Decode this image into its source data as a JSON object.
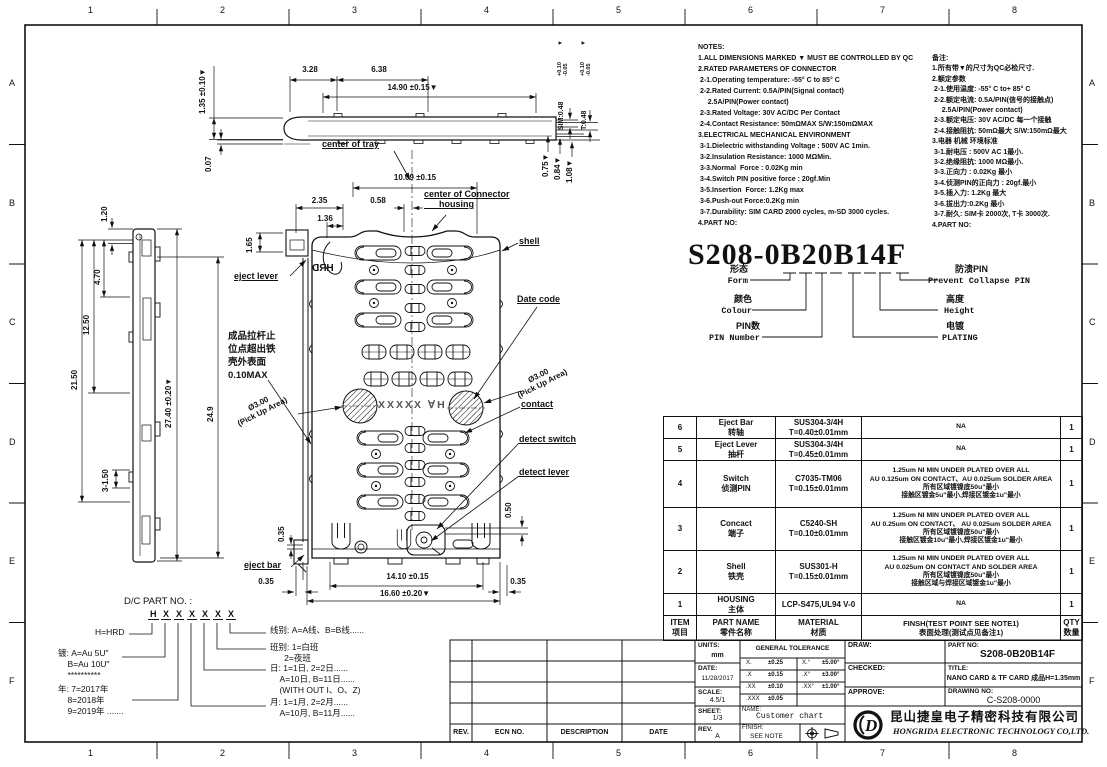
{
  "sheet": {
    "zone_cols": [
      "1",
      "2",
      "3",
      "4",
      "5",
      "6",
      "7",
      "8"
    ],
    "zone_rows": [
      "A",
      "B",
      "C",
      "D",
      "E",
      "F"
    ]
  },
  "notes_en": "NOTES:\n1.ALL DIMENSIONS MARKED ▼ MUST BE CONTROLLED BY QC\n2.RATED PARAMETERS OF CONNECTOR\n 2-1.Operating temperature: -55° C to 85° C\n 2-2.Rated Current: 0.5A/PIN(Signal contact)\n     2.5A/PIN(Power contact)\n 2-3.Rated Voltage: 30V AC/DC Per Contact\n 2-4.Contact Resistance: 50mΩMAX S/W:150mΩMAX\n3.ELECTRICAL MECHANICAL ENVIRONMENT\n 3-1.Dielectric withstanding Voltage : 500V AC 1min.\n 3-2.Insulation Resistance: 1000 MΩMin.\n 3-3.Normal  Force : 0.02Kg min\n 3-4.Switch PIN positive force : 20gf.Min\n 3-5.Insertion  Force: 1.2Kg max\n 3-6.Push-out Force:0.2Kg min\n 3-7.Durability: SIM CARD 2000 cycles, m-SD 3000 cycles.\n4.PART NO:",
  "notes_cn": "备注:\n1.所有带▼的尺寸为QC必检尺寸.\n2.额定参数\n 2-1.使用温度: -55° C to+ 85° C\n 2-2.额定电流: 0.5A/PIN(信号的接触点)\n     2.5A/PIN(Power contact)\n 2-3.额定电压: 30V AC/DC 每一个接触\n 2-4.接触阻抗: 50mΩ最大 S/W:150mΩ最大\n3.电器 机械 环境标准\n 3-1.耐电压 : 500V AC 1最小.\n 3-2.绝缘阻抗: 1000 MΩ最小.\n 3-3.正向力 : 0.02Kg 最小\n 3-4.侦测PIN的正向力 : 20gf.最小\n 3-5.插入力: 1.2Kg 最大\n 3-6.拔出力:0.2Kg 最小\n 3-7.耐久: SIM卡 2000次, T卡 3000次.\n4.PART NO:",
  "part_code": {
    "number": "S208-0B20B14F",
    "form_cn": "形态",
    "form_en": "Form",
    "colour_cn": "颜色",
    "colour_en": "Colour",
    "pin_cn": "PIN数",
    "pin_en": "PIN Number",
    "prevent_cn": "防溃PIN",
    "prevent_en": "Prevent Collapse PIN",
    "height_cn": "高度",
    "height_en": "Height",
    "plating_cn": "电镀",
    "plating_en": "PLATING"
  },
  "bom": {
    "header": {
      "item": "ITEM\n项目",
      "part_name": "PART NAME\n零件名称",
      "material": "MATERIAL\n材质",
      "finish": "FINSH(TEST POINT SEE NOTE1)\n表面处理(测试点见备注1)",
      "qty": "QTY\n数量"
    },
    "rows": [
      {
        "item": "6",
        "part_name": "Eject Bar\n转轴",
        "material": "SUS304-3/4H\nT=0.40±0.01mm",
        "finish": "NA",
        "qty": "1"
      },
      {
        "item": "5",
        "part_name": "Eject Lever\n抽杆",
        "material": "SUS304-3/4H\nT=0.45±0.01mm",
        "finish": "NA",
        "qty": "1"
      },
      {
        "item": "4",
        "part_name": "Switch\n侦测PIN",
        "material": "C7035-TM06\nT=0.15±0.01mm",
        "finish": "1.25um NI MIN UNDER PLATED OVER ALL\nAU 0.125um ON CONTACT、AU 0.025um SOLDER AREA\n所有区域镀镍底50u\"最小\n接触区镀金5u\"最小,焊接区镀金1u\"最小",
        "qty": "1"
      },
      {
        "item": "3",
        "part_name": "Concact\n端子",
        "material": "C5240-SH\nT=0.10±0.01mm",
        "finish": "1.25um NI MIN UNDER PLATED OVER ALL\nAU 0.25um ON CONTACT、 AU 0.025um SOLDER AREA\n所有区域镀镍底50u\"最小\n接触区镀金10u\"最小,焊接区镀金1u\"最小",
        "qty": "1"
      },
      {
        "item": "2",
        "part_name": "Shell\n铁壳",
        "material": "SUS301-H\nT=0.15±0.01mm",
        "finish": "1.25um NI MIN UNDER PLATED OVER ALL\nAU 0.025um ON CONTACT AND SOLDER AREA\n所有区域镀镍底50u\"最小\n接触区域与焊接区域镀金1u\"最小",
        "qty": "1"
      },
      {
        "item": "1",
        "part_name": "HOUSING\n主体",
        "material": "LCP-S475,UL94 V-0",
        "finish": "NA",
        "qty": "1"
      }
    ]
  },
  "title_block": {
    "rev_table": {
      "rev": "REV.",
      "ecn": "ECN NO.",
      "description": "DESCRIPTION",
      "date": "DATE"
    },
    "units_label": "UNITS:",
    "units": "mm",
    "date_label": "DATE:",
    "date": "11/28/2017",
    "scale_label": "SCALE:",
    "scale": "4.5/1",
    "sheet_label": "SHEET:",
    "sheet": "1/3",
    "rev_label": "REV.",
    "rev": "A",
    "tol_title": "GENERAL TOLERANCE",
    "tol": {
      "r1l": "X.",
      "r1lv": "±0.25",
      "r1r": "X.°",
      "r1rv": "±5.00°",
      "r2l": ".X",
      "r2lv": "±0.15",
      "r2r": ".X°",
      "r2rv": "±3.00°",
      "r3l": ".XX",
      "r3lv": "±0.10",
      "r3r": ".XX°",
      "r3rv": "±1.00°",
      "r4l": ".XXX",
      "r4lv": "±0.05"
    },
    "name_label": "NAME:",
    "name": "Customer chart",
    "finish_label": "FINISH:",
    "finish": "SEE NOTE",
    "draw_label": "DRAW:",
    "checked_label": "CHECKED:",
    "approve_label": "APPROVE:",
    "part_no_label": "PART NO:",
    "part_no": "S208-0B20B14F",
    "title_label": "TITLE:",
    "title": "NANO CARD & TF CARD 成品H=1.35mm",
    "drawing_no_label": "DRAWING NO:",
    "drawing_no": "C-S208-0000",
    "company_cn": "昆山捷皇电子精密科技有限公司",
    "company_en": "HONGRIDA ELECTRONIC TECHNOLOGY CO,LTD.",
    "logo_text": "D"
  },
  "dc_legend": {
    "title": "D/C PART NO. :",
    "code_chars": [
      "H",
      "X",
      "X",
      "X",
      "X",
      "X",
      "X"
    ],
    "h": "H=HRD",
    "plating": "镀: A=Au 5U\"\n    B=Au 10U\"\n    **********",
    "year": "年: 7=2017年\n    8=2018年\n    9=2019年 .......",
    "month": "月: 1=1月, 2=2月......\n    A=10月, B=11月......",
    "day": "日: 1=1日, 2=2日......\n    A=10日, B=11日......\n    (WITH OUT I、O、Z)",
    "shift": "班别: 1=白班\n      2=夜班",
    "line": "线别: A=A线、B=B线......"
  },
  "drawing": {
    "labels": {
      "center_of_tray": "center of tray",
      "center_of_connector": "center of Connector\n      housing",
      "shell": "shell",
      "eject_lever": "eject lever",
      "date_code": "Date code",
      "contact": "contact",
      "detect_switch": "detect switch",
      "detect_lever": "detect lever",
      "eject_bar": "eject bar",
      "stop_note": "成品拉杆止\n位点超出铁\n壳外表面\n0.10MAX",
      "pickup": "Ø3.00\n(Pick Up Area)",
      "marking": "XXXXX ∀H",
      "hrd": "HRD"
    },
    "dims": {
      "d135": "1.35 ±0.10▼",
      "d007": "0.07",
      "d328": "3.28",
      "d638": "6.38",
      "d1490": "14.90 ±0.15▼",
      "sim048": "SIM:0.48",
      "t048": "T:0.48",
      "tol": "+0.10\n-0.05",
      "qc": "▼",
      "d075": "0.75▼",
      "d084": "0.84▼",
      "d108": "1.08▼",
      "d1009": "10.09 ±0.15",
      "d235": "2.35",
      "d136": "1.36",
      "d058": "0.58",
      "d165": "1.65",
      "d120": "1.20",
      "d470": "4.70",
      "d1250": "12.50",
      "d2150": "21.50",
      "d3150": "3-1.50",
      "d2740": "27.40 ±0.20▼",
      "d249": "24.9",
      "d035a": "0.35",
      "d035b": "0.35",
      "d035c": "0.35",
      "d050": "0.50",
      "d1410": "14.10 ±0.15",
      "d1660": "16.60 ±0.20▼"
    }
  }
}
